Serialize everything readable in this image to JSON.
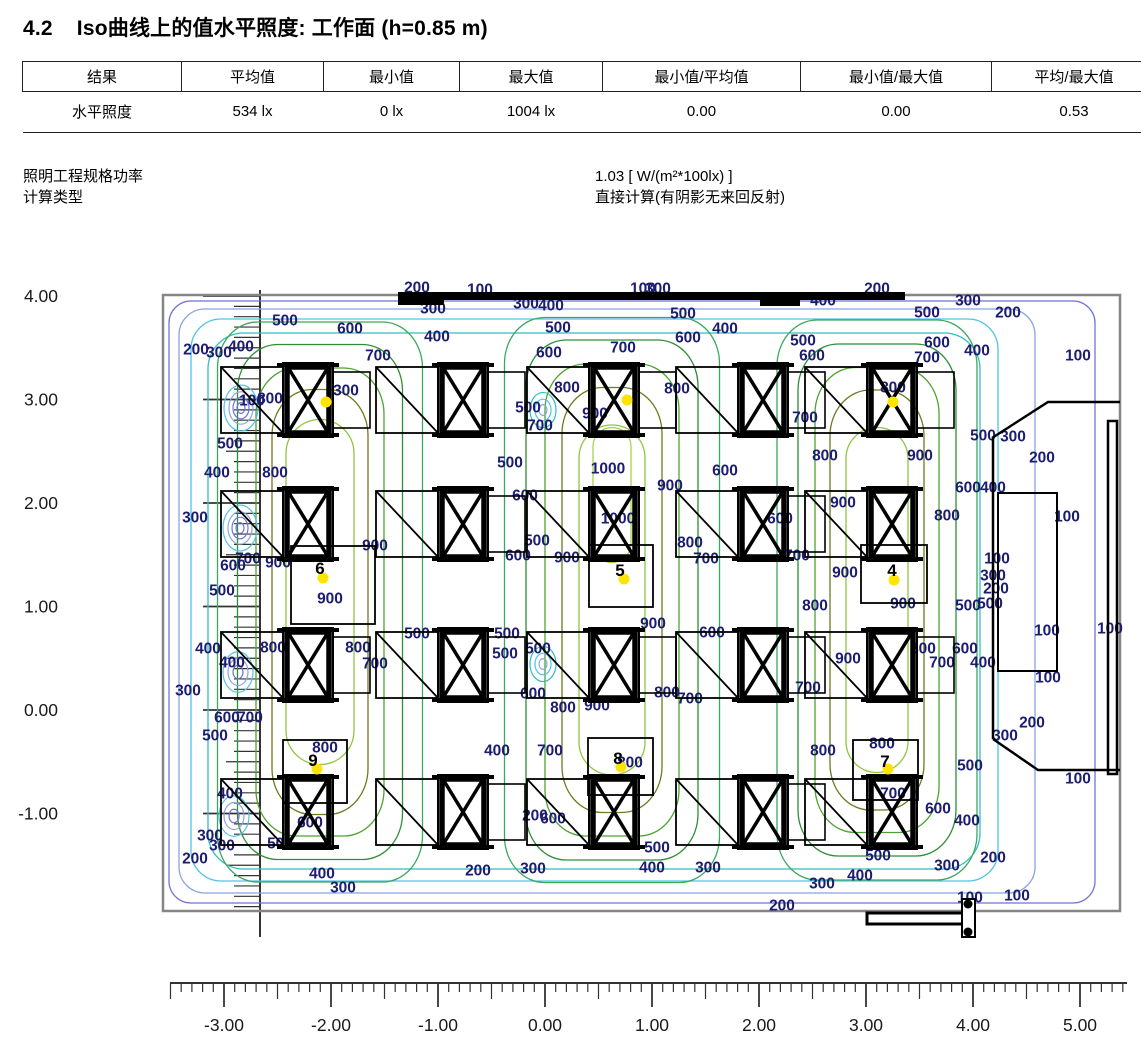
{
  "header": {
    "section": "4.2",
    "title": "Iso曲线上的值水平照度: 工作面 (h=0.85 m)"
  },
  "table": {
    "headers": [
      "结果",
      "平均值",
      "最小值",
      "最大值",
      "最小值/平均值",
      "最小值/最大值",
      "平均/最大值"
    ],
    "col_widths": [
      154,
      137,
      131,
      138,
      193,
      186,
      160
    ],
    "rows": [
      [
        "水平照度",
        "534 lx",
        "0 lx",
        "1004 lx",
        "0.00",
        "0.00",
        "0.53"
      ]
    ]
  },
  "info": [
    {
      "label": "照明工程规格功率",
      "value": "1.03 [ W/(m²*100lx) ]"
    },
    {
      "label": "计算类型",
      "value": "直接计算(有阴影无来回反射)"
    }
  ],
  "chart_data": {
    "type": "contour",
    "quantity": "水平照度",
    "unit": "lx",
    "plane_height_m": 0.85,
    "stats": {
      "average": "534 lx",
      "min": "0 lx",
      "max": "1004 lx",
      "min_over_avg": "0.00",
      "min_over_max": "0.00",
      "avg_over_max": "0.53"
    },
    "axes": {
      "x": {
        "min": -3.5,
        "max": 5.4,
        "majors": [
          -3,
          -2,
          -1,
          0,
          1,
          2,
          3,
          4,
          5
        ]
      },
      "y": {
        "min": -1.9,
        "max": 4.0,
        "majors": [
          4,
          3,
          2,
          1,
          0,
          -1
        ]
      }
    },
    "levels": [
      100,
      200,
      300,
      400,
      500,
      600,
      700,
      800,
      900,
      1000
    ],
    "level_colors": {
      "100": "#7272d8",
      "200": "#88a4e2",
      "300": "#4fc3e8",
      "400": "#2fbfbf",
      "500": "#3aa85f",
      "600": "#2c8f35",
      "700": "#4da32f",
      "800": "#6e7a1f",
      "900": "#8fc63e",
      "1000": "#a5d44a"
    },
    "label_color": "#1c1c70",
    "luminaires": [
      {
        "id": "6",
        "num": [
          320,
          568
        ],
        "dot": [
          323,
          578
        ]
      },
      {
        "id": "5",
        "num": [
          620,
          570
        ],
        "dot": [
          624,
          579
        ]
      },
      {
        "id": "4",
        "num": [
          892,
          570
        ],
        "dot": [
          894,
          580
        ]
      },
      {
        "id": "9",
        "num": [
          313,
          760
        ],
        "dot": [
          317,
          769
        ]
      },
      {
        "id": "8",
        "num": [
          618,
          758
        ],
        "dot": [
          621,
          767
        ]
      },
      {
        "id": "7",
        "num": [
          885,
          761
        ],
        "dot": [
          888,
          769
        ]
      },
      {
        "id": "",
        "num": null,
        "dot": [
          326,
          402
        ]
      },
      {
        "id": "",
        "num": null,
        "dot": [
          627,
          400
        ]
      },
      {
        "id": "",
        "num": null,
        "dot": [
          893,
          402
        ]
      }
    ],
    "contour_labels": [
      [
        100,
        480,
        289
      ],
      [
        200,
        417,
        287
      ],
      [
        300,
        526,
        303
      ],
      [
        300,
        433,
        308
      ],
      [
        400,
        551,
        305
      ],
      [
        500,
        558,
        327
      ],
      [
        600,
        549,
        352
      ],
      [
        400,
        437,
        336
      ],
      [
        200,
        196,
        349
      ],
      [
        300,
        219,
        352
      ],
      [
        400,
        241,
        346
      ],
      [
        500,
        285,
        320
      ],
      [
        600,
        350,
        328
      ],
      [
        700,
        378,
        355
      ],
      [
        100,
        643,
        288
      ],
      [
        300,
        658,
        288
      ],
      [
        500,
        683,
        313
      ],
      [
        600,
        688,
        337
      ],
      [
        400,
        725,
        328
      ],
      [
        700,
        623,
        347
      ],
      [
        400,
        823,
        300
      ],
      [
        200,
        877,
        288
      ],
      [
        500,
        803,
        340
      ],
      [
        600,
        812,
        355
      ],
      [
        500,
        927,
        312
      ],
      [
        600,
        937,
        342
      ],
      [
        400,
        977,
        350
      ],
      [
        300,
        968,
        300
      ],
      [
        200,
        1008,
        312
      ],
      [
        100,
        1078,
        355
      ],
      [
        800,
        270,
        398
      ],
      [
        100,
        252,
        400
      ],
      [
        300,
        346,
        390
      ],
      [
        800,
        567,
        387
      ],
      [
        900,
        595,
        413
      ],
      [
        500,
        528,
        407
      ],
      [
        700,
        540,
        425
      ],
      [
        800,
        677,
        388
      ],
      [
        800,
        893,
        387
      ],
      [
        700,
        927,
        357
      ],
      [
        700,
        805,
        417
      ],
      [
        500,
        983,
        435
      ],
      [
        300,
        1013,
        436
      ],
      [
        200,
        1042,
        457
      ],
      [
        500,
        230,
        443
      ],
      [
        400,
        217,
        472
      ],
      [
        800,
        275,
        472
      ],
      [
        900,
        375,
        545
      ],
      [
        300,
        195,
        517
      ],
      [
        500,
        510,
        462
      ],
      [
        1000,
        608,
        468
      ],
      [
        900,
        670,
        485
      ],
      [
        600,
        725,
        470
      ],
      [
        600,
        525,
        495
      ],
      [
        1000,
        618,
        518
      ],
      [
        800,
        825,
        455
      ],
      [
        900,
        920,
        455
      ],
      [
        600,
        968,
        487
      ],
      [
        400,
        993,
        487
      ],
      [
        100,
        1067,
        516
      ],
      [
        900,
        843,
        502
      ],
      [
        800,
        947,
        515
      ],
      [
        600,
        780,
        518
      ],
      [
        700,
        797,
        555
      ],
      [
        900,
        845,
        572
      ],
      [
        600,
        233,
        565
      ],
      [
        700,
        248,
        558
      ],
      [
        900,
        278,
        562
      ],
      [
        900,
        330,
        598
      ],
      [
        500,
        222,
        590
      ],
      [
        500,
        537,
        540
      ],
      [
        600,
        518,
        555
      ],
      [
        900,
        567,
        557
      ],
      [
        800,
        690,
        542
      ],
      [
        700,
        706,
        558
      ],
      [
        100,
        997,
        558
      ],
      [
        300,
        993,
        575
      ],
      [
        200,
        996,
        588
      ],
      [
        500,
        990,
        603
      ],
      [
        100,
        1047,
        630
      ],
      [
        100,
        1110,
        628
      ],
      [
        400,
        208,
        648
      ],
      [
        800,
        273,
        647
      ],
      [
        400,
        232,
        662
      ],
      [
        800,
        358,
        647
      ],
      [
        700,
        375,
        663
      ],
      [
        300,
        188,
        690
      ],
      [
        600,
        227,
        717
      ],
      [
        700,
        250,
        717
      ],
      [
        500,
        215,
        735
      ],
      [
        500,
        417,
        633
      ],
      [
        500,
        507,
        633
      ],
      [
        500,
        505,
        653
      ],
      [
        500,
        538,
        648
      ],
      [
        900,
        653,
        623
      ],
      [
        600,
        533,
        693
      ],
      [
        800,
        563,
        707
      ],
      [
        900,
        597,
        705
      ],
      [
        800,
        667,
        692
      ],
      [
        700,
        690,
        698
      ],
      [
        600,
        712,
        632
      ],
      [
        800,
        815,
        605
      ],
      [
        900,
        903,
        603
      ],
      [
        500,
        968,
        605
      ],
      [
        900,
        848,
        658
      ],
      [
        800,
        923,
        648
      ],
      [
        600,
        965,
        648
      ],
      [
        700,
        942,
        662
      ],
      [
        400,
        983,
        662
      ],
      [
        700,
        808,
        687
      ],
      [
        100,
        1048,
        677
      ],
      [
        400,
        497,
        750
      ],
      [
        700,
        550,
        750
      ],
      [
        800,
        630,
        762
      ],
      [
        800,
        325,
        747
      ],
      [
        400,
        230,
        793
      ],
      [
        200,
        535,
        815
      ],
      [
        600,
        553,
        818
      ],
      [
        200,
        1032,
        722
      ],
      [
        300,
        1005,
        735
      ],
      [
        800,
        823,
        750
      ],
      [
        800,
        882,
        743
      ],
      [
        500,
        970,
        765
      ],
      [
        100,
        1078,
        778
      ],
      [
        600,
        938,
        808
      ],
      [
        400,
        967,
        820
      ],
      [
        700,
        893,
        793
      ],
      [
        300,
        210,
        835
      ],
      [
        300,
        222,
        845
      ],
      [
        200,
        195,
        858
      ],
      [
        500,
        280,
        843
      ],
      [
        600,
        310,
        822
      ],
      [
        400,
        322,
        873
      ],
      [
        300,
        343,
        887
      ],
      [
        200,
        478,
        870
      ],
      [
        300,
        533,
        868
      ],
      [
        400,
        652,
        867
      ],
      [
        500,
        657,
        847
      ],
      [
        300,
        708,
        867
      ],
      [
        500,
        878,
        855
      ],
      [
        300,
        947,
        865
      ],
      [
        200,
        993,
        857
      ],
      [
        300,
        822,
        883
      ],
      [
        400,
        860,
        875
      ],
      [
        200,
        782,
        905
      ],
      [
        100,
        970,
        897
      ],
      [
        100,
        1017,
        895
      ]
    ],
    "render": {
      "room": [
        163,
        295,
        957,
        616
      ],
      "x_ruler": {
        "line_y": 983,
        "x0": 170,
        "x1": 1127,
        "px0": 545,
        "scale": 107,
        "tick_major": 24,
        "tick_half": 16,
        "tick_minor": 9,
        "label_y": 1031
      },
      "y_ruler": {
        "line_x": 260,
        "y0": 290,
        "y1": 937,
        "px0": 296,
        "scale": 103.5,
        "tick_major": 57,
        "tick_half": 34,
        "tick_minor": 26,
        "label_x": 58
      },
      "inset_rings": [
        [
          100,
          169,
          301,
          926,
          602,
          22
        ],
        [
          200,
          179,
          309,
          856,
          584,
          26
        ],
        [
          300,
          191,
          319,
          807,
          562,
          30
        ],
        [
          400,
          208,
          333,
          772,
          536,
          36
        ]
      ],
      "families": [
        {
          "cx": 320,
          "cy": 602,
          "rings": [
            [
              500,
              205,
              560,
              0
            ],
            [
              600,
              165,
              515,
              0
            ],
            [
              700,
              128,
              468,
              0
            ],
            [
              800,
              96,
              425,
              0
            ],
            [
              900,
              68,
              345,
              -10
            ]
          ]
        },
        {
          "cx": 612,
          "cy": 600,
          "rings": [
            [
              500,
              215,
              565,
              0
            ],
            [
              600,
              172,
              520,
              0
            ],
            [
              700,
              134,
              472,
              0
            ],
            [
              800,
              100,
              425,
              0
            ],
            [
              900,
              66,
              350,
              0
            ],
            [
              1000,
              38,
              135,
              -105
            ]
          ]
        },
        {
          "cx": 877,
          "cy": 600,
          "rings": [
            [
              500,
              200,
              560,
              0
            ],
            [
              600,
              158,
              512,
              0
            ],
            [
              700,
              124,
              465,
              0
            ],
            [
              800,
              94,
              420,
              0
            ],
            [
              900,
              62,
              345,
              0
            ]
          ]
        }
      ],
      "pockets": [
        {
          "x": 241,
          "y": 408,
          "rings": [
            [
              17,
              "300"
            ],
            [
              12,
              "200"
            ],
            [
              8,
              "100"
            ],
            [
              4,
              "100"
            ]
          ]
        },
        {
          "x": 240,
          "y": 528,
          "rings": [
            [
              17,
              "300"
            ],
            [
              12,
              "200"
            ],
            [
              8,
              "100"
            ],
            [
              4,
              "100"
            ]
          ]
        },
        {
          "x": 238,
          "y": 672,
          "rings": [
            [
              15,
              "300"
            ],
            [
              10,
              "200"
            ],
            [
              5,
              "100"
            ]
          ]
        },
        {
          "x": 234,
          "y": 816,
          "rings": [
            [
              15,
              "300"
            ],
            [
              10,
              "200"
            ],
            [
              5,
              "100"
            ]
          ]
        },
        {
          "x": 543,
          "y": 410,
          "rings": [
            [
              13,
              "400"
            ],
            [
              8,
              "300"
            ],
            [
              4,
              "200"
            ]
          ]
        },
        {
          "x": 543,
          "y": 664,
          "rings": [
            [
              13,
              "400"
            ],
            [
              8,
              "300"
            ],
            [
              4,
              "200"
            ]
          ]
        }
      ],
      "walls": {
        "board": [
          398,
          292,
          507,
          8
        ],
        "board_blobs": [
          [
            398,
            292,
            46,
            13
          ],
          [
            760,
            292,
            40,
            14
          ]
        ],
        "bay_lines": [
          [
            [
              992,
              438
            ],
            [
              1048,
              402
            ],
            [
              1120,
              402
            ]
          ],
          [
            [
              993,
              438
            ],
            [
              993,
              739
            ]
          ],
          [
            [
              993,
              739
            ],
            [
              1038,
              770
            ],
            [
              1120,
              770
            ]
          ]
        ],
        "cabinet": [
          998,
          493,
          59,
          178
        ],
        "column": [
          1108,
          421,
          9,
          353
        ],
        "door_leaf": [
          867,
          913,
          103,
          11
        ],
        "door_plate": [
          962,
          899,
          13,
          38
        ],
        "door_hinges": [
          [
            968,
            904
          ],
          [
            968,
            932
          ]
        ]
      },
      "furniture": {
        "cols": [
          308,
          463,
          614,
          763,
          892
        ],
        "rows": [
          400,
          524,
          665,
          812
        ],
        "square_stations": [
          [
            0,
            1
          ],
          [
            2,
            1
          ],
          [
            4,
            1
          ],
          [
            0,
            3
          ],
          [
            2,
            3
          ],
          [
            4,
            3
          ]
        ]
      },
      "squares": [
        [
          291,
          546,
          84,
          78
        ],
        [
          589,
          545,
          64,
          62
        ],
        [
          861,
          545,
          66,
          58
        ],
        [
          283,
          740,
          64,
          63
        ],
        [
          588,
          738,
          65,
          57
        ],
        [
          853,
          740,
          65,
          60
        ]
      ]
    }
  }
}
